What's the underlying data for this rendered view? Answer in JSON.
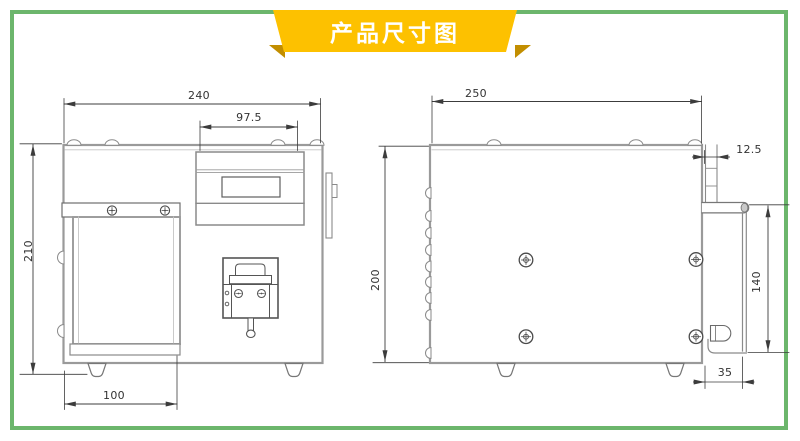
{
  "banner": {
    "title": "产品尺寸图"
  },
  "colors": {
    "banner_bg": "#FDC100",
    "banner_fold": "#C28E00",
    "banner_text": "#FFFFFF",
    "frame_border": "#6CB66C",
    "outline_gray": "#9A9A9A",
    "dimension_dark": "#3C3C3C"
  },
  "front_view": {
    "dims": {
      "total_width": "240",
      "panel_width": "97.5",
      "total_height": "210",
      "door_width": "100"
    }
  },
  "side_view": {
    "dims": {
      "total_depth": "250",
      "handle_offset": "12.5",
      "body_height": "200",
      "bracket_height": "140",
      "bracket_depth": "35"
    }
  }
}
